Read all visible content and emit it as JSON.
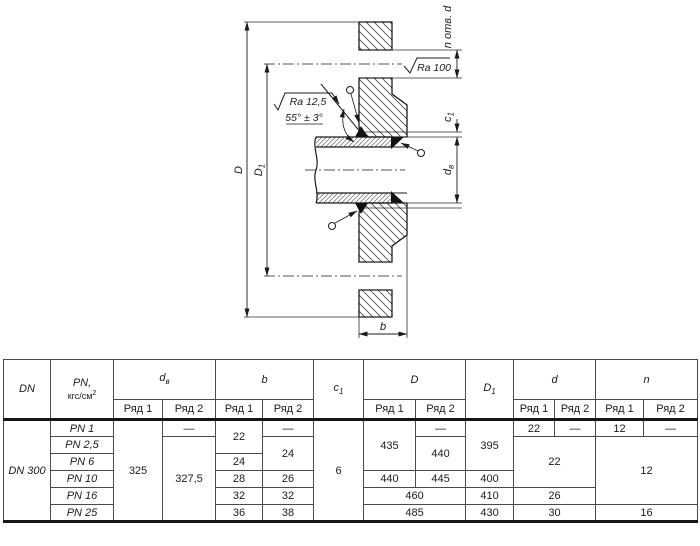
{
  "drawing": {
    "holes_label": "n отв. d",
    "ra_100": "Ra 100",
    "ra_125": "Ra 12,5",
    "angle": "55° ± 3°",
    "dim_D": "D",
    "dim_D1": {
      "main": "D",
      "sub": "1"
    },
    "dim_c1": {
      "main": "c",
      "sub": "1"
    },
    "dim_dv": {
      "main": "d",
      "sub": "в"
    },
    "dim_b": "b"
  },
  "table": {
    "header": {
      "dn": "DN",
      "pn_line1": "PN,",
      "pn_base": "кгс/см",
      "pn_sup": "2",
      "dv": {
        "main": "d",
        "sub": "в"
      },
      "b": "b",
      "c1": {
        "main": "c",
        "sub": "1"
      },
      "D": "D",
      "D1": {
        "main": "D",
        "sub": "1"
      },
      "d": "d",
      "n": "n",
      "ryad1": "Ряд 1",
      "ryad2": "Ряд 2"
    },
    "shared": {
      "dn": "DN 300",
      "dv1": "325",
      "c1": "6"
    },
    "rows": {
      "r1": {
        "pn": "PN 1",
        "dv2": "—",
        "b1": "22",
        "b2": "—",
        "D1": "435",
        "D2": "—",
        "D1dim": "395",
        "d1": "22",
        "d2": "—",
        "n1": "12",
        "n2": "—"
      },
      "r2": {
        "pn": "PN 2,5",
        "dv2": "327,5",
        "b2": "24",
        "D2": "440",
        "d": "22",
        "n": "12"
      },
      "r3": {
        "pn": "PN 6",
        "b1": "24"
      },
      "r4": {
        "pn": "PN 10",
        "b1": "28",
        "b2": "26",
        "D1": "440",
        "D2": "445",
        "D1dim": "400"
      },
      "r5": {
        "pn": "PN 16",
        "b1": "32",
        "b2": "32",
        "D": "460",
        "D1dim": "410",
        "d": "26"
      },
      "r6": {
        "pn": "PN 25",
        "b1": "36",
        "b2": "38",
        "D": "485",
        "D1dim": "430",
        "d": "30",
        "n": "16"
      }
    }
  }
}
